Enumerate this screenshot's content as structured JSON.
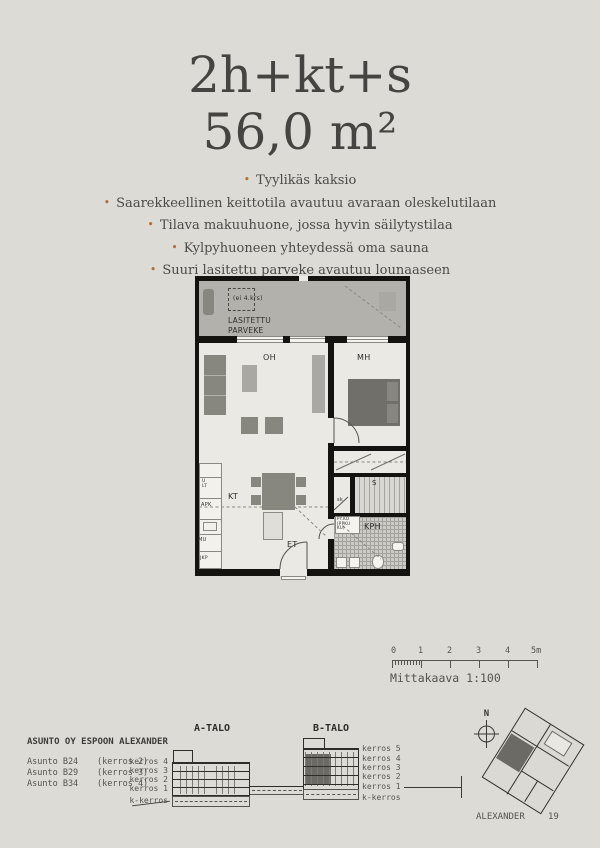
{
  "header": {
    "title": "2h+kt+s",
    "area": "56,0 m²"
  },
  "features": {
    "bullet": "•",
    "items": [
      "Tyylikäs kaksio",
      "Saarekkeellinen keittotila avautuu avaraan oleskelutilaan",
      "Tilava makuuhuone, jossa hyvin säilytystilaa",
      "Kylpyhuoneen yhteydessä oma sauna",
      "Suuri lasitettu parveke avautuu lounaaseen"
    ]
  },
  "floorplan": {
    "balcony": {
      "note": "(ei 4.krs)",
      "label1": "LASITETTU",
      "label2": "PARVEKE"
    },
    "rooms": {
      "living": "OH",
      "bedroom": "MH",
      "kitchen": "KT",
      "entry": "ET",
      "bathroom": "KPH",
      "sauna": "S",
      "closet": "sk"
    },
    "appliances": {
      "stove1": "U",
      "stove2": "LT",
      "dishwasher": "APK",
      "microwave": "MU",
      "fridge": "JKP",
      "washer1": "PY.KO",
      "washer2": "(PPKU",
      "washer3": "KU)"
    }
  },
  "scalebar": {
    "ticks": [
      "0",
      "1",
      "2",
      "3",
      "4",
      "5m"
    ],
    "caption": "Mittakaava 1:100"
  },
  "housing": {
    "company": "ASUNTO OY ESPOON ALEXANDER",
    "apartments": [
      {
        "name": "Asunto B24",
        "floor": "(kerros 2)"
      },
      {
        "name": "Asunto B29",
        "floor": "(kerros 3)"
      },
      {
        "name": "Asunto B34",
        "floor": "(kerros 4)"
      }
    ]
  },
  "elevations": {
    "a": {
      "label": "A-TALO",
      "floors": [
        "kerros 4",
        "kerros 3",
        "kerros 2",
        "kerros 1",
        "k-kerros"
      ]
    },
    "b": {
      "label": "B-TALO",
      "floors": [
        "kerros 5",
        "kerros 4",
        "kerros 3",
        "kerros 2",
        "kerros 1",
        "k-kerros"
      ]
    }
  },
  "siteplan": {
    "compass": "N",
    "project": "ALEXANDER",
    "page": "19"
  }
}
